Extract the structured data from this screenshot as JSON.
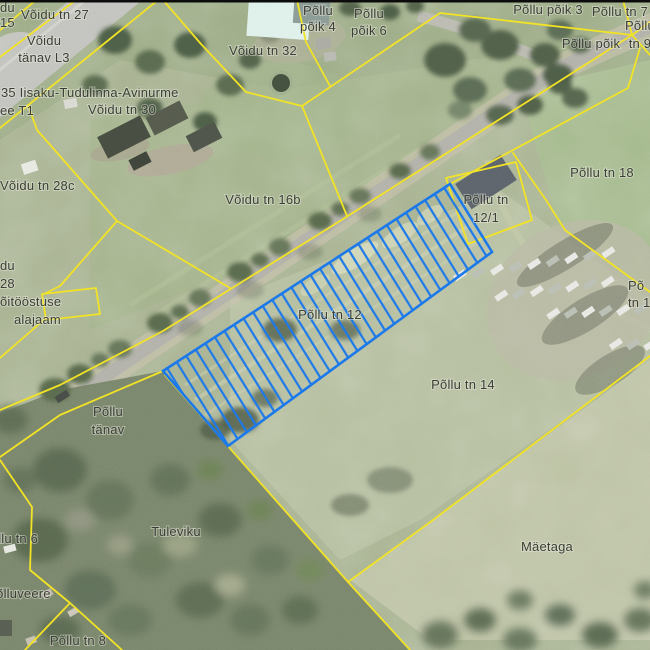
{
  "map": {
    "type": "cadastral-aerial-map",
    "boundary_color": "#f2e326",
    "label_color": "#3c3f37",
    "top_border_color": "#0c0c0c",
    "selected_parcel": {
      "label": "Põllu tn 12",
      "stroke": "#1c79ea",
      "hatch_spacing": 11.4,
      "hatch_angle": -31.7,
      "hatch_line_width": 2.2,
      "outline_width": 2.6,
      "polygon": [
        [
          163,
          371
        ],
        [
          450,
          184
        ],
        [
          492,
          252
        ],
        [
          228,
          446
        ]
      ]
    },
    "boundaries": [
      {
        "name": "corner-cross-1",
        "points": [
          [
            0,
            30
          ],
          [
            36,
            0
          ]
        ]
      },
      {
        "name": "corner-cross-2",
        "points": [
          [
            0,
            57
          ],
          [
            76,
            0
          ]
        ]
      },
      {
        "name": "corner-cross-3",
        "points": [
          [
            0,
            128
          ],
          [
            158,
            0
          ]
        ]
      },
      {
        "name": "north-zigzag",
        "points": [
          [
            163,
            0
          ],
          [
            201,
            44
          ],
          [
            246,
            92
          ],
          [
            302,
            106
          ],
          [
            440,
            13
          ],
          [
            632,
            35
          ]
        ]
      },
      {
        "name": "building-spur",
        "points": [
          [
            297,
            0
          ],
          [
            306,
            42
          ],
          [
            330,
            86
          ]
        ]
      },
      {
        "name": "v32-16b-divider",
        "points": [
          [
            302,
            106
          ],
          [
            347,
            216
          ]
        ]
      },
      {
        "name": "ne-fan-up",
        "points": [
          [
            632,
            35
          ],
          [
            623,
            0
          ]
        ]
      },
      {
        "name": "ne-fan-right-1",
        "points": [
          [
            632,
            35
          ],
          [
            650,
            22
          ]
        ]
      },
      {
        "name": "ne-fan-right-2",
        "points": [
          [
            632,
            35
          ],
          [
            650,
            55
          ]
        ]
      },
      {
        "name": "road-nw-side",
        "points": [
          [
            632,
            35
          ],
          [
            340,
            221
          ],
          [
            163,
            331
          ],
          [
            60,
            385
          ],
          [
            0,
            410
          ]
        ]
      },
      {
        "name": "road-se-side",
        "points": [
          [
            640,
            48
          ],
          [
            628,
            88
          ],
          [
            450,
            184
          ],
          [
            163,
            371
          ],
          [
            60,
            415
          ],
          [
            0,
            457
          ]
        ]
      },
      {
        "name": "parcel-12-1",
        "points": [
          [
            446,
            178
          ],
          [
            516,
            162
          ],
          [
            532,
            220
          ],
          [
            468,
            244
          ],
          [
            446,
            178
          ]
        ]
      },
      {
        "name": "tn18-west",
        "points": [
          [
            513,
            153
          ],
          [
            546,
            200
          ],
          [
            565,
            230
          ],
          [
            650,
            292
          ]
        ]
      },
      {
        "name": "v28c-east",
        "points": [
          [
            28,
            105
          ],
          [
            37,
            130
          ],
          [
            117,
            221
          ],
          [
            230,
            288
          ]
        ]
      },
      {
        "name": "alajaam-link",
        "points": [
          [
            117,
            221
          ],
          [
            60,
            286
          ],
          [
            44,
            294
          ]
        ]
      },
      {
        "name": "alajaam-west",
        "points": [
          [
            46,
            318
          ],
          [
            0,
            358
          ]
        ]
      },
      {
        "name": "alajaam-square",
        "points": [
          [
            42,
            294
          ],
          [
            96,
            288
          ],
          [
            100,
            314
          ],
          [
            46,
            320
          ],
          [
            42,
            294
          ]
        ]
      },
      {
        "name": "sw-parcels",
        "points": [
          [
            0,
            460
          ],
          [
            32,
            507
          ],
          [
            30,
            570
          ],
          [
            70,
            603
          ]
        ]
      },
      {
        "name": "tn8-west",
        "points": [
          [
            70,
            603
          ],
          [
            25,
            650
          ]
        ]
      },
      {
        "name": "tn8-east",
        "points": [
          [
            70,
            603
          ],
          [
            122,
            650
          ]
        ]
      },
      {
        "name": "tuleviku-east",
        "points": [
          [
            165,
            375
          ],
          [
            348,
            582
          ]
        ]
      },
      {
        "name": "maetaga-north",
        "points": [
          [
            650,
            356
          ],
          [
            433,
            520
          ],
          [
            348,
            582
          ]
        ]
      },
      {
        "name": "maetaga-south",
        "points": [
          [
            348,
            582
          ],
          [
            410,
            650
          ]
        ]
      }
    ],
    "labels": [
      {
        "id": "corner-cut-line1",
        "lines": [
          "du"
        ],
        "x": 0,
        "y": 12,
        "anchor": "start"
      },
      {
        "id": "corner-cut-line2",
        "lines": [
          "15"
        ],
        "x": 0,
        "y": 27,
        "anchor": "start"
      },
      {
        "id": "voidu-tn-27",
        "lines": [
          "Võidu tn 27"
        ],
        "x": 55,
        "y": 19,
        "anchor": "middle"
      },
      {
        "id": "voidu-tanav-l3",
        "lines": [
          "Võidu",
          "tänav L3"
        ],
        "x": 44,
        "y": 45,
        "lh": 17,
        "anchor": "middle"
      },
      {
        "id": "road-35-line1",
        "lines": [
          "35 Iisaku-Tudulinna-Avinurme"
        ],
        "x": 1,
        "y": 97,
        "anchor": "start"
      },
      {
        "id": "road-35-line2",
        "lines": [
          "ee T1"
        ],
        "x": 0,
        "y": 115,
        "anchor": "start"
      },
      {
        "id": "voidu-tn-30",
        "lines": [
          "Võidu tn 30"
        ],
        "x": 122,
        "y": 114,
        "anchor": "middle"
      },
      {
        "id": "voidu-tn-32",
        "lines": [
          "Võidu tn 32"
        ],
        "x": 263,
        "y": 55,
        "anchor": "middle"
      },
      {
        "id": "pollu-poik-4",
        "lines": [
          "Põllu",
          "põik 4"
        ],
        "x": 318,
        "y": 15,
        "lh": 16,
        "anchor": "middle"
      },
      {
        "id": "pollu-poik-6",
        "lines": [
          "Põllu",
          "põik 6"
        ],
        "x": 369,
        "y": 18,
        "lh": 17,
        "anchor": "middle"
      },
      {
        "id": "pollu-poik-3",
        "lines": [
          "Põllu põik 3"
        ],
        "x": 548,
        "y": 14,
        "anchor": "middle"
      },
      {
        "id": "pollu-tn-7",
        "lines": [
          "Põllu tn 7"
        ],
        "x": 620,
        "y": 16,
        "anchor": "middle"
      },
      {
        "id": "pollu-tn-9",
        "lines": [
          "Põllu",
          "tn 9"
        ],
        "x": 640,
        "y": 30,
        "lh": 18,
        "anchor": "middle"
      },
      {
        "id": "pollu-poik",
        "lines": [
          "Põllu põik"
        ],
        "x": 591,
        "y": 48,
        "anchor": "middle"
      },
      {
        "id": "voidu-tn-28c",
        "lines": [
          "Võidu tn 28c"
        ],
        "x": 0,
        "y": 190,
        "anchor": "start"
      },
      {
        "id": "voidu-tn-16b",
        "lines": [
          "Võidu tn 16b"
        ],
        "x": 263,
        "y": 204,
        "anchor": "middle"
      },
      {
        "id": "edge-cut-du",
        "lines": [
          "du"
        ],
        "x": 0,
        "y": 270,
        "anchor": "start"
      },
      {
        "id": "edge-cut-28",
        "lines": [
          "28"
        ],
        "x": 0,
        "y": 288,
        "anchor": "start"
      },
      {
        "id": "alajaam-line1",
        "lines": [
          "õitööstuse"
        ],
        "x": 0,
        "y": 306,
        "anchor": "start"
      },
      {
        "id": "alajaam-line2",
        "lines": [
          "alajaam"
        ],
        "x": 14,
        "y": 324,
        "anchor": "start"
      },
      {
        "id": "pollu-tn-18",
        "lines": [
          "Põllu tn 18"
        ],
        "x": 602,
        "y": 177,
        "anchor": "middle"
      },
      {
        "id": "pollu-tn-12-1",
        "lines": [
          "Põllu tn",
          "12/1"
        ],
        "x": 486,
        "y": 204,
        "lh": 18,
        "anchor": "middle"
      },
      {
        "id": "pollu-tn-16-cut",
        "lines": [
          "Põ",
          "tn 1"
        ],
        "x": 628,
        "y": 290,
        "lh": 17,
        "anchor": "start"
      },
      {
        "id": "pollu-tn-12",
        "lines": [
          "Põllu tn 12"
        ],
        "x": 330,
        "y": 319,
        "anchor": "middle"
      },
      {
        "id": "pollu-tn-14",
        "lines": [
          "Põllu tn 14"
        ],
        "x": 463,
        "y": 389,
        "anchor": "middle"
      },
      {
        "id": "pollu-tanav",
        "lines": [
          "Põllu",
          "tänav"
        ],
        "x": 108,
        "y": 416,
        "lh": 18,
        "anchor": "middle"
      },
      {
        "id": "tuleviku",
        "lines": [
          "Tuleviku"
        ],
        "x": 176,
        "y": 536,
        "anchor": "middle"
      },
      {
        "id": "maetaga",
        "lines": [
          "Mäetaga"
        ],
        "x": 547,
        "y": 551,
        "anchor": "middle"
      },
      {
        "id": "pollu-tn-6",
        "lines": [
          "Põllu tn 6"
        ],
        "x": 10,
        "y": 543,
        "anchor": "middle"
      },
      {
        "id": "polluveere",
        "lines": [
          "Põlluveere"
        ],
        "x": 19,
        "y": 598,
        "anchor": "middle"
      },
      {
        "id": "pollu-tn-8",
        "lines": [
          "Põllu tn 8"
        ],
        "x": 78,
        "y": 645,
        "anchor": "middle"
      }
    ]
  }
}
